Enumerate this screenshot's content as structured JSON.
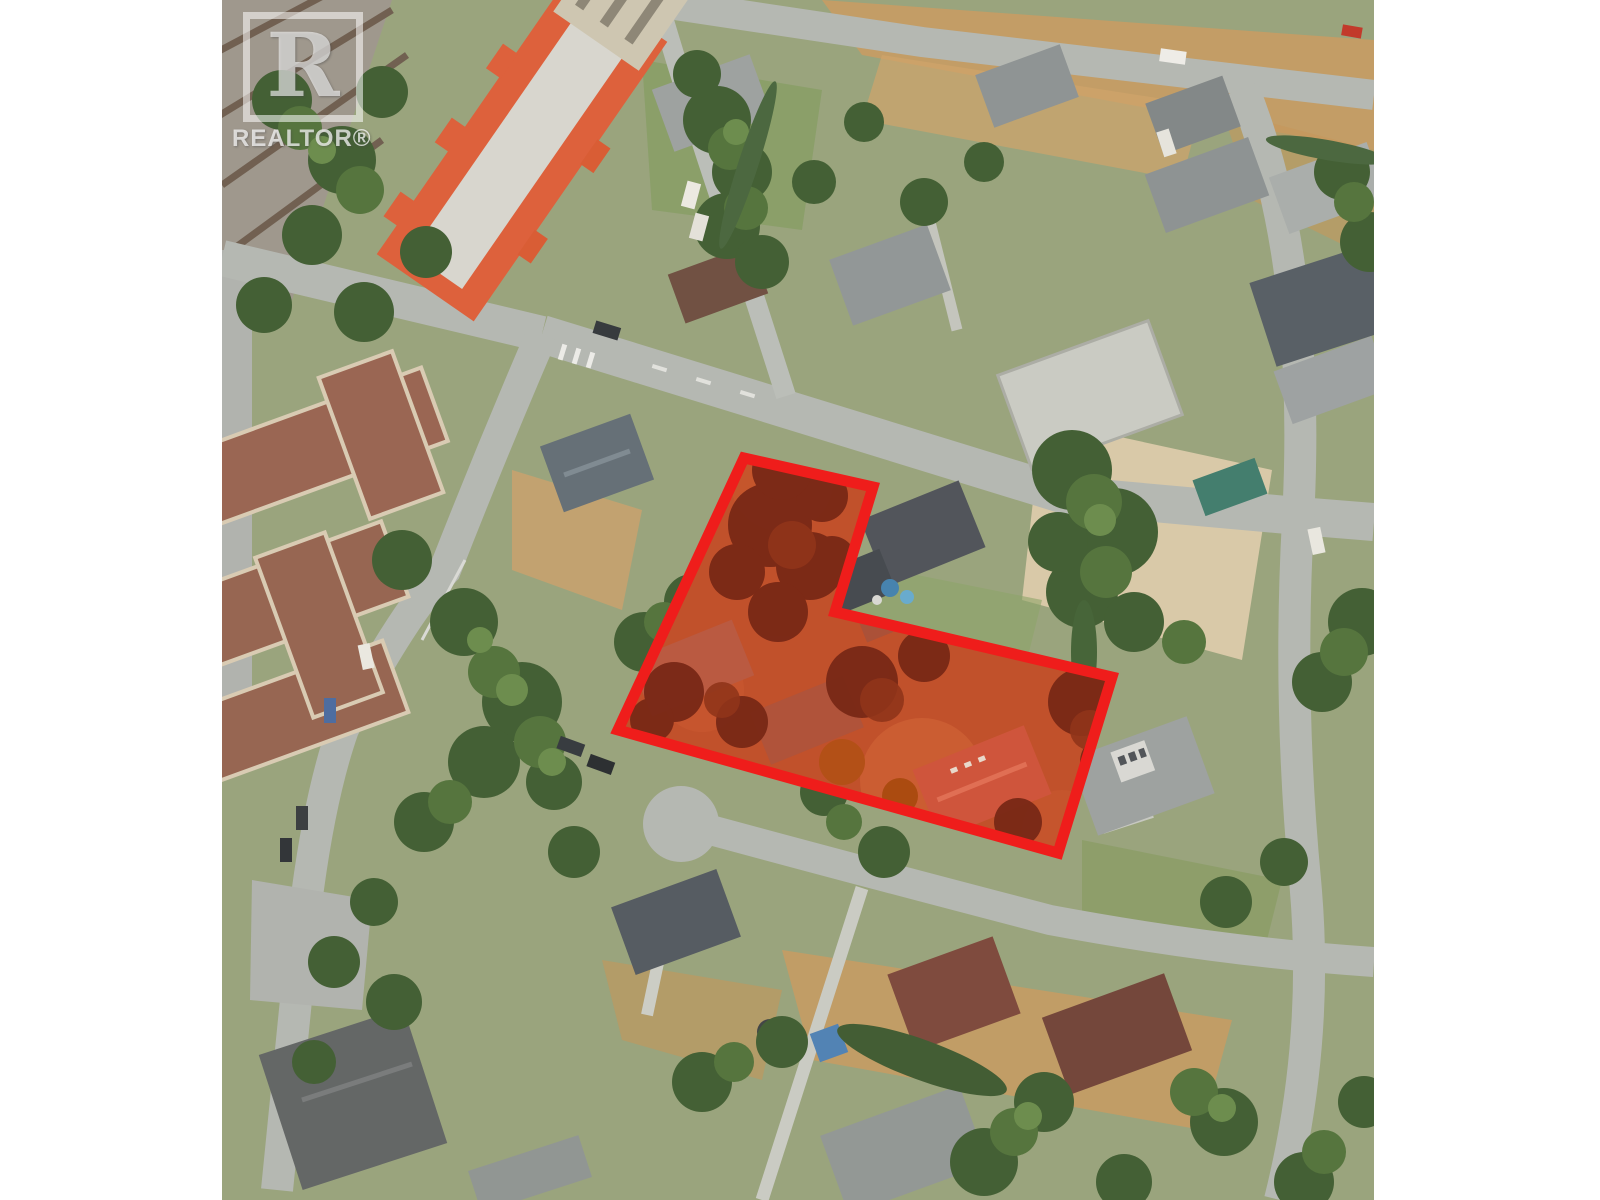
{
  "photo": {
    "left_px": 222,
    "top_px": 0,
    "width_px": 1152,
    "height_px": 1200
  },
  "watermark": {
    "logo_letter": "R",
    "brand": "REALTOR®"
  },
  "parcel_highlight": {
    "points": "522,458 651,487 613,612 890,677 836,853 396,730",
    "stroke_color": "#f01414",
    "stroke_width": 11,
    "tint_color": "#bf4a24"
  }
}
